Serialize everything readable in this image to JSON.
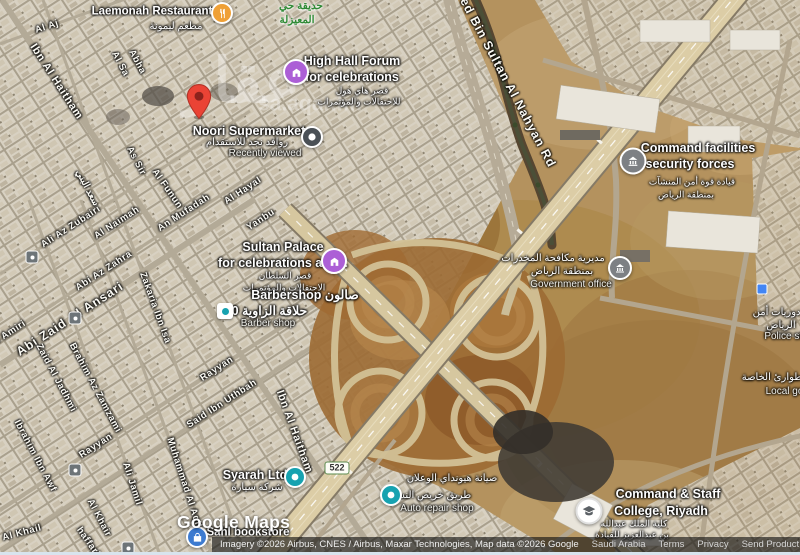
{
  "park": {
    "line1": "حديقة حي",
    "line2": "المعيزلة"
  },
  "watermark": {
    "arabic": "عقار",
    "domain": "sa.aqar.fm"
  },
  "roads": {
    "nahyan_rd": "Zayed Bin Sultan Al Nahyan Rd",
    "route_shield": "522"
  },
  "streets": {
    "al_aj": "Al Aj",
    "ibn_al_haitham": "Ibn Al Haitham",
    "al_sa": "Al Sa",
    "abha": "Abha",
    "as_sir": "As Sir",
    "al_funun": "Al Funun",
    "al_hayal": "Al Hayal",
    "yanbu": "Yanbu",
    "an_mufadah": "An Mufadah",
    "al_naimah": "Al Naimah",
    "ali_az_zubairi": "Ali Az Zubairi",
    "abi_az_zahra": "Abi Az Zahra",
    "abi_zaid_al_ansari": "Abi Zaid Al Ansari",
    "zakaria_ibn_isa": "Zakaria Ibn Isa",
    "al_amiri": "Al Amiri",
    "saad_al_bunni": "سعد البني",
    "rayyan": "Rayyan",
    "said_ibn_uthbah": "Said Ibn Uthbah",
    "zaid_al_jadhmi": "Zaid Al Jadhmi",
    "brahim_az_zamzami": "Brahim Az Zamzami",
    "ibrahim_ibn_awf": "Ibrahim Ibn Awf",
    "ali_jamil": "Ali Jamil",
    "muhammad_al_aqil": "Muhammad Al Aqil",
    "al_khair": "Al Khair",
    "al_khail": "Al Khail",
    "haffari": "haffari"
  },
  "pois": {
    "laemonah": {
      "name": "Laemonah Restaurant",
      "arabic": "مطعم ليمونة"
    },
    "high_hall": {
      "line1": "High Hall Forum",
      "line2": "for celebrations",
      "arabic1": "قصر هاي هول",
      "arabic2": "للاحتفالات والمؤتمرات"
    },
    "noori": {
      "name": "Noori Supermarket",
      "arabic": "روافد نجد للاستقدام",
      "status": "Recently viewed"
    },
    "sultan_palace": {
      "line1": "Sultan Palace",
      "line2": "for celebrations and...",
      "arabic1": "قصر السلطان",
      "arabic2": "الاحتفالات والمؤتمرات"
    },
    "barbershop": {
      "line1": "Barbershop صالون",
      "line2": "حلاقة الزاوية 90",
      "category": "Barber shop"
    },
    "command_facilities": {
      "line1": "Command facilities",
      "line2": "security forces",
      "arabic1": "قيادة قوة أمن المنشآت",
      "arabic2": "بمنطقة الرياض"
    },
    "government_office": {
      "arabic1": "مديرية مكافحة المخدرات",
      "arabic2": "بمنطقة الرياض",
      "category": "Government office"
    },
    "police_station": {
      "arabic1": "ادارة دوريات أمن",
      "arabic2": "الرياض",
      "category": "Police sta"
    },
    "special_emergency": {
      "arabic": "الطوارئ الخاصة",
      "category": "Local gov"
    },
    "college": {
      "line1": "Command & Staff",
      "line2": "College, Riyadh",
      "arabic1": "كلية الملك عبدالله",
      "arabic2": "بن عبدالعزيز للقيادة"
    },
    "syarah": {
      "name": "Syarah Ltd",
      "arabic": "شركة سيارة"
    },
    "auto_repair": {
      "arabic1": "صيانة هيونداي الوعلان",
      "arabic2": "طريق خريص النسيم",
      "category": "Auto repair shop"
    },
    "bookstore": {
      "name": "Sahl bookstore"
    }
  },
  "logo": "Google Maps",
  "attribution": {
    "imagery": "Imagery ©2026 Airbus, CNES / Airbus, Maxar Technologies, Map data ©2026 Google",
    "region": "Saudi Arabia",
    "terms": "Terms",
    "privacy": "Privacy",
    "feedback": "Send Product Feedback",
    "scale": "200 m"
  }
}
